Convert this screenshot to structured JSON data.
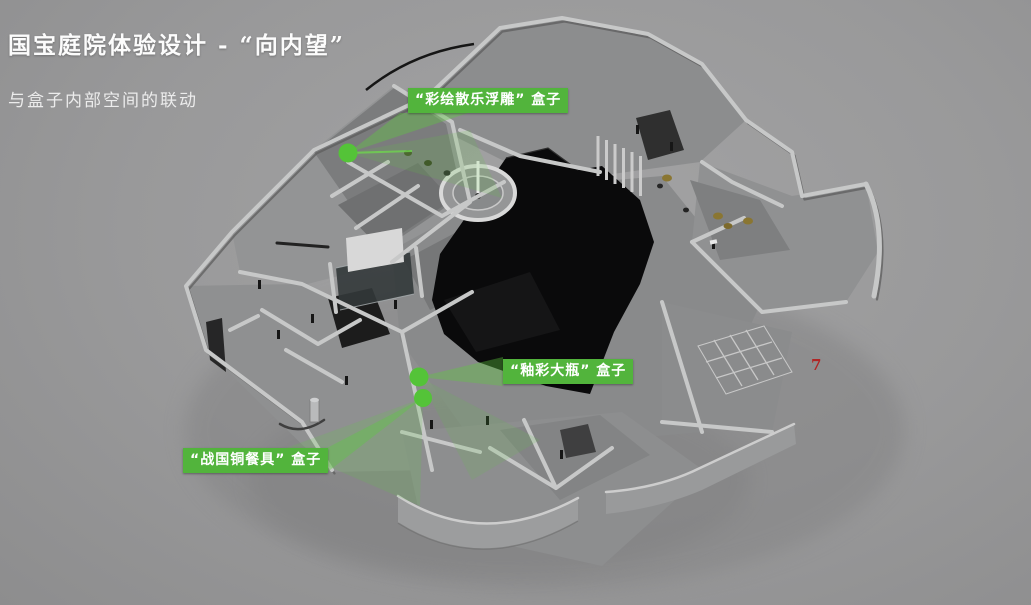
{
  "page": {
    "title": "国宝庭院体验设计 - “向内望”",
    "subtitle": "与盒子内部空间的联动",
    "page_number": "7"
  },
  "annotations": {
    "labels": [
      {
        "id": "caihui-sanle-relief-box",
        "text": "“彩绘散乐浮雕” 盒子"
      },
      {
        "id": "youcai-vase-box",
        "text": "“釉彩大瓶” 盒子"
      },
      {
        "id": "zhanguo-tableware-box",
        "text": "“战国铜餐具” 盒子"
      }
    ],
    "hotspots": [
      {
        "id": "hotspot-caihui",
        "x": 348,
        "y": 153
      },
      {
        "id": "hotspot-youcai",
        "x": 419,
        "y": 377
      },
      {
        "id": "hotspot-zhanguo",
        "x": 423,
        "y": 398
      }
    ]
  },
  "colors": {
    "accent_green": "#54c338",
    "label_green": "#52b43c",
    "beam_green": "#5fcb40",
    "page_number_red": "#b02525",
    "background_gray": "#99999a",
    "model_black": "#0a0a0b"
  }
}
